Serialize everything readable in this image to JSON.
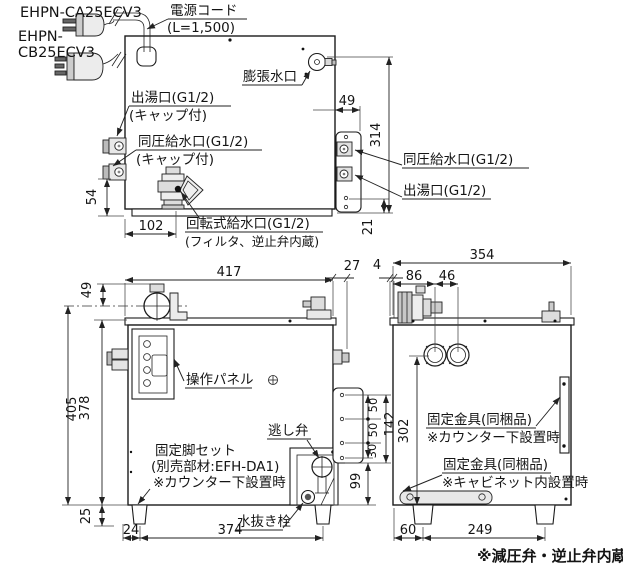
{
  "drawing": {
    "models": {
      "a": "EHPN-CA25ECV3",
      "b1": "EHPN-",
      "b2": "CB25ECV3"
    },
    "top": {
      "power_cord": "電源コード",
      "power_cord_len": "(L=1,500)",
      "expansion": "膨張水口",
      "outlet": "出湯口(G1/2)",
      "outlet_cap": "(キャップ付)",
      "ep_inlet": "同圧給水口(G1/2)",
      "ep_inlet_cap": "(キャップ付)",
      "rotary": "回転式給水口(G1/2)",
      "rotary_note": "(フィルタ、逆止弁内蔵)",
      "right_ep_inlet": "同圧給水口(G1/2)",
      "right_outlet": "出湯口(G1/2)",
      "d49": "49",
      "d314": "314",
      "d21": "21",
      "d54": "54",
      "d102": "102"
    },
    "front": {
      "panel": "操作パネル",
      "leg1": "固定脚セット",
      "leg2": "(別売部材:EFH-DA1)",
      "leg3": "※カウンター下設置時",
      "relief": "逃し弁",
      "drain": "水抜き栓",
      "d417": "417",
      "d49": "49",
      "d405": "405",
      "d378": "378",
      "d25": "25",
      "d24": "24",
      "d374": "374",
      "d27": "27",
      "d4": "4",
      "d50a": "50",
      "d50b": "50",
      "d30": "30",
      "d142": "142",
      "d99": "99"
    },
    "side": {
      "bracket1": "固定金具(同梱品)",
      "bracket1_note": "※カウンター下設置時",
      "bracket2": "固定金具(同梱品)",
      "bracket2_note": "※キャビネット内設置時",
      "d354": "354",
      "d86": "86",
      "d46": "46",
      "d302": "302",
      "d60": "60",
      "d249": "249"
    },
    "footnote": "※減圧弁・逆止弁内蔵"
  }
}
